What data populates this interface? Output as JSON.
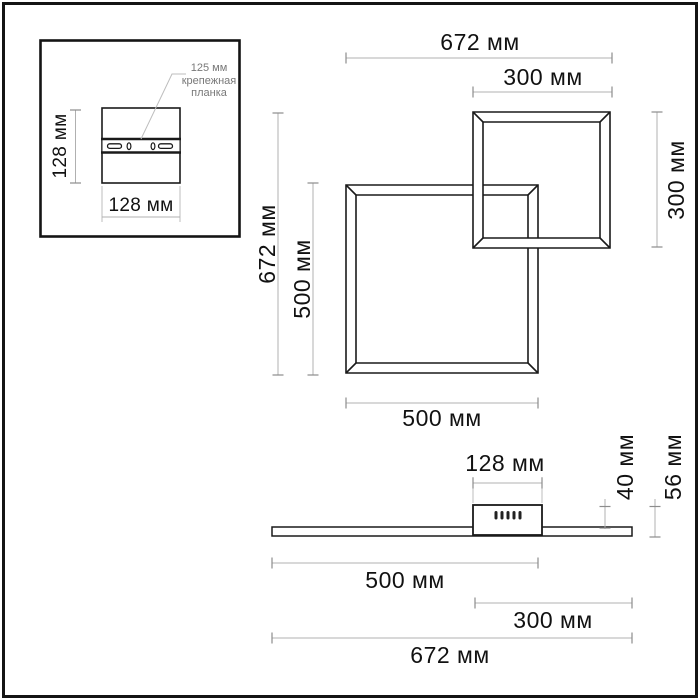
{
  "colors": {
    "outline": "#1a1a1a",
    "dimension_line": "#b0b0b0",
    "tick": "#8c8c8c",
    "dimension_text": "#111111",
    "callout_text": "#787878",
    "background": "#ffffff"
  },
  "inset": {
    "height_label": "128 мм",
    "width_label": "128 мм",
    "callout_line1": "125 мм",
    "callout_line2": "крепежная",
    "callout_line3": "планка"
  },
  "front_view": {
    "overall_width": "672 мм",
    "small_square_width": "300 мм",
    "small_square_height": "300 мм",
    "overall_height": "672 мм",
    "large_square_height": "500 мм",
    "large_square_width": "500 мм"
  },
  "side_view": {
    "canopy_width": "128 мм",
    "canopy_height": "40 мм",
    "overall_height": "56 мм",
    "left_section_length": "500 мм",
    "right_section_length": "300 мм",
    "overall_length": "672 мм"
  }
}
